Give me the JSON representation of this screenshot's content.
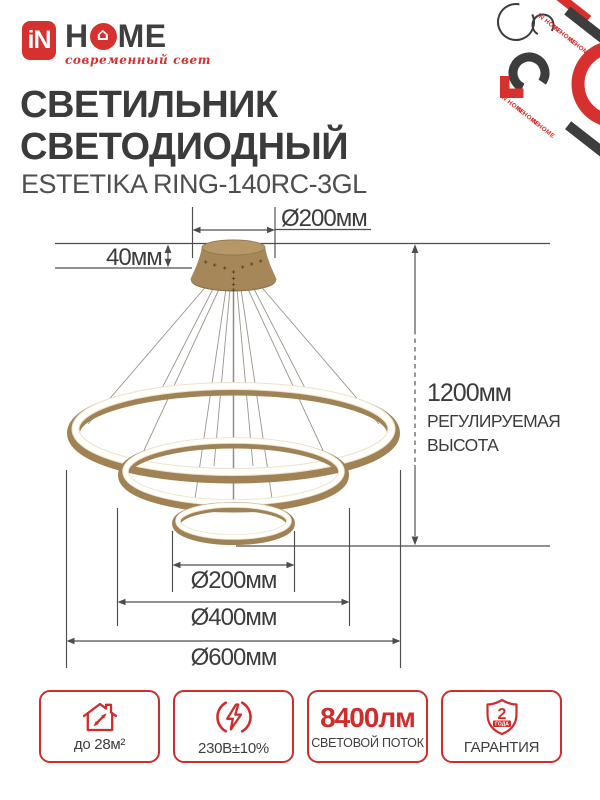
{
  "brand": {
    "mark": "iN",
    "home_left": "H",
    "home_right": "ME",
    "house_glyph": "⌂",
    "tagline": "современный свет"
  },
  "title": {
    "line1": "СВЕТИЛЬНИК",
    "line2": "СВЕТОДИОДНЫЙ"
  },
  "model": "ESTETIKA RING-140RC-3GL",
  "diagram": {
    "canopy_diameter": "Ø200мм",
    "canopy_height": "40мм",
    "height_value": "1200мм",
    "height_note_line1": "РЕГУЛИРУЕМАЯ",
    "height_note_line2": "ВЫСОТА",
    "ring_small": "Ø200мм",
    "ring_middle": "Ø400мм",
    "ring_large": "Ø600мм"
  },
  "badges": {
    "area": {
      "label": "до 28м²"
    },
    "voltage": {
      "label": "230В±10%"
    },
    "flux": {
      "value": "8400лм",
      "label": "СВЕТОВОЙ ПОТОК"
    },
    "warranty": {
      "shield_number": "2",
      "shield_caption": "ГОДА",
      "label": "ГАРАНТИЯ"
    }
  },
  "decoration": {
    "watermark": "IN HOME"
  },
  "colors": {
    "red": "#d6312e",
    "badge_red": "#cf2d2c",
    "dark_text": "#3b3b3b",
    "line": "#4d4d4d",
    "gold": "#a5875a",
    "gold_light": "#b59768",
    "gold_dark": "#8f7247"
  }
}
